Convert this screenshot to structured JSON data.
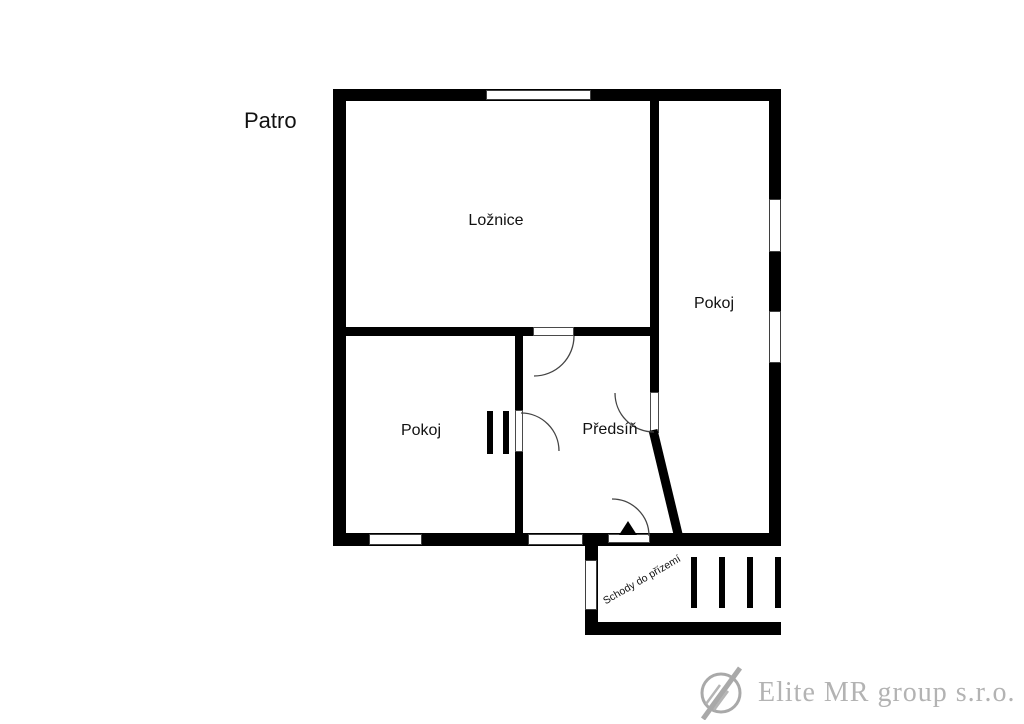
{
  "title": "Patro",
  "plan": {
    "rooms": [
      {
        "id": "loznice",
        "label": "Ložnice"
      },
      {
        "id": "pokoj-right",
        "label": "Pokoj"
      },
      {
        "id": "pokoj-left",
        "label": "Pokoj"
      },
      {
        "id": "predsin",
        "label": "Předsíň"
      }
    ],
    "stairs_label": "Schody do přízemí"
  },
  "watermark": {
    "company": "Elite MR group s.r.o."
  },
  "colors": {
    "wall": "#000000",
    "background": "#ffffff",
    "watermark_text": "#b3b3b3",
    "watermark_logo": "#a9a9a9"
  }
}
